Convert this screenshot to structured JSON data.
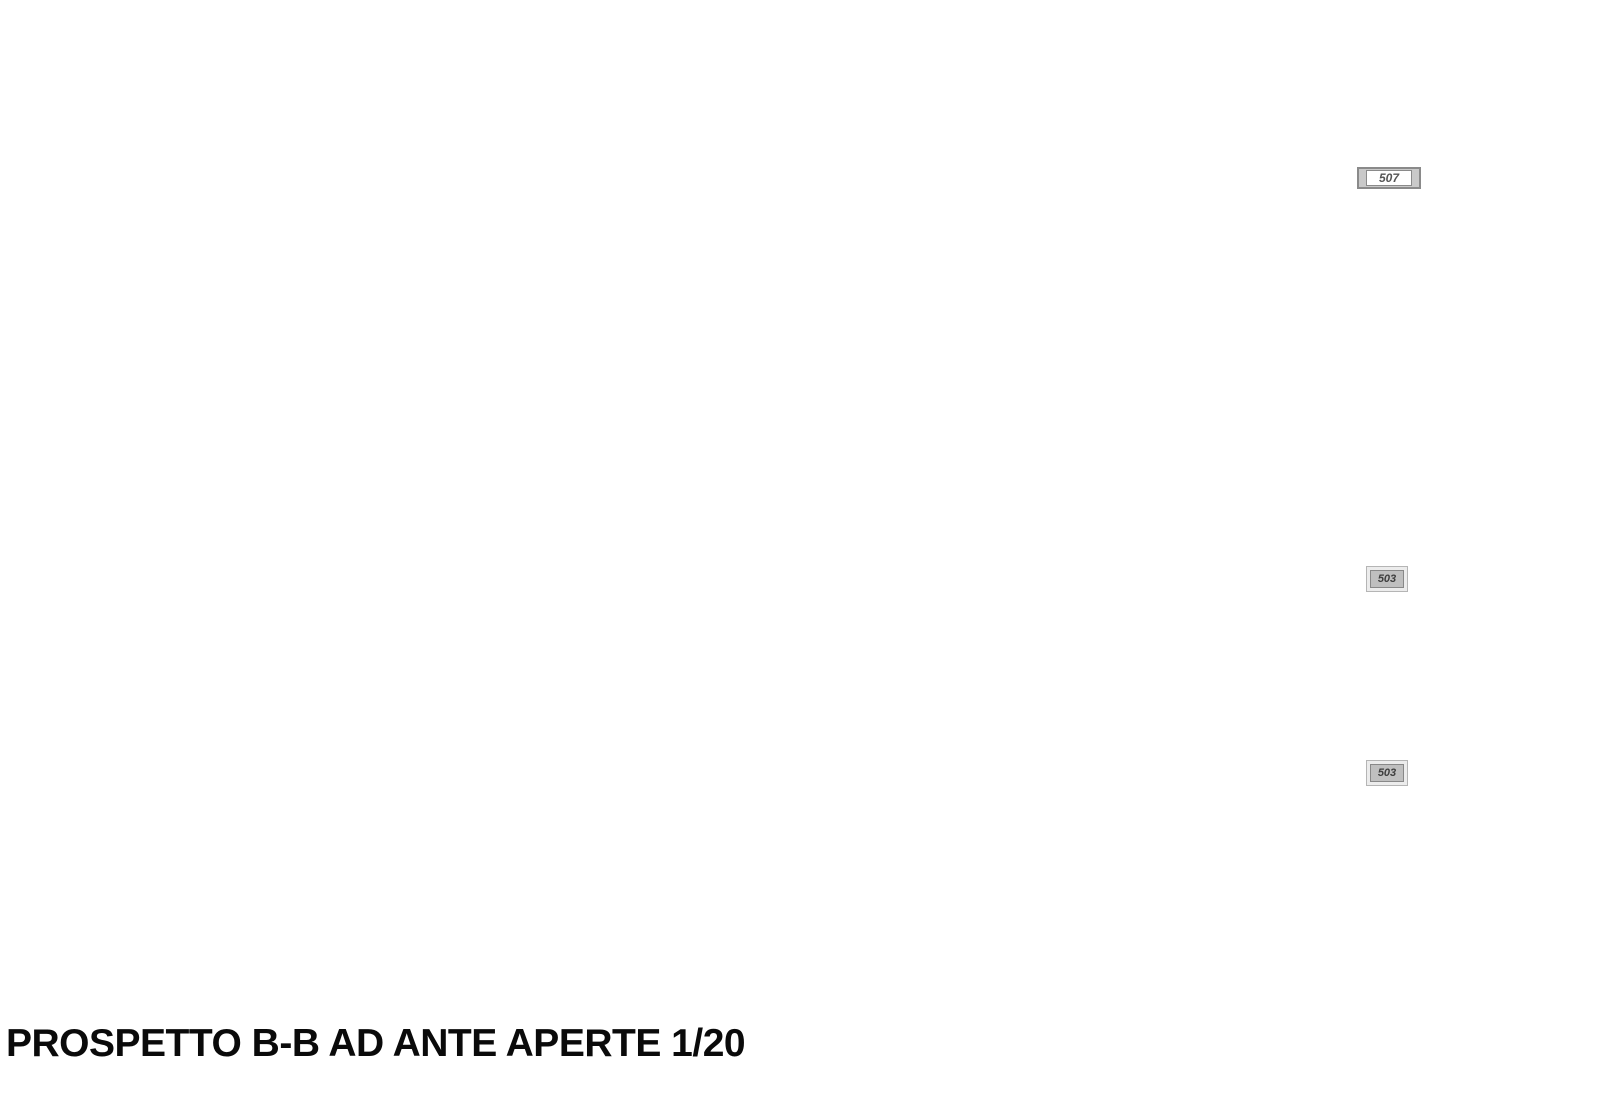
{
  "drawing": {
    "title": "PROSPETTO B-B AD ANTE APERTE 1/20",
    "shelf_label": {
      "line1": "Ripiano riposizionabile",
      "line2": "in laminato termoformato"
    },
    "vent_label": "Anta per ventil.",
    "tags": {
      "top": "507",
      "mid": "503",
      "low": "503"
    },
    "colors": {
      "fill_gray": "#c9c9c9",
      "line_gray": "#787878",
      "dark_line": "#4c4c4c",
      "dash_gray": "#9a9a9a",
      "dim_text": "#8a8a8a"
    },
    "dimensions": {
      "overall_height": "2400",
      "left_chain": [
        "30",
        "30",
        "350",
        "30",
        "350",
        "30",
        "350",
        "30",
        "350",
        "30",
        "350",
        "30",
        "430",
        "60"
      ],
      "bottom_chain": [
        "30",
        "925",
        "30",
        "30",
        "460",
        "30",
        "460",
        "30",
        "30",
        "460",
        "30",
        "460",
        "30"
      ],
      "bottom_overall": "3045",
      "beam_offset": "30"
    }
  }
}
